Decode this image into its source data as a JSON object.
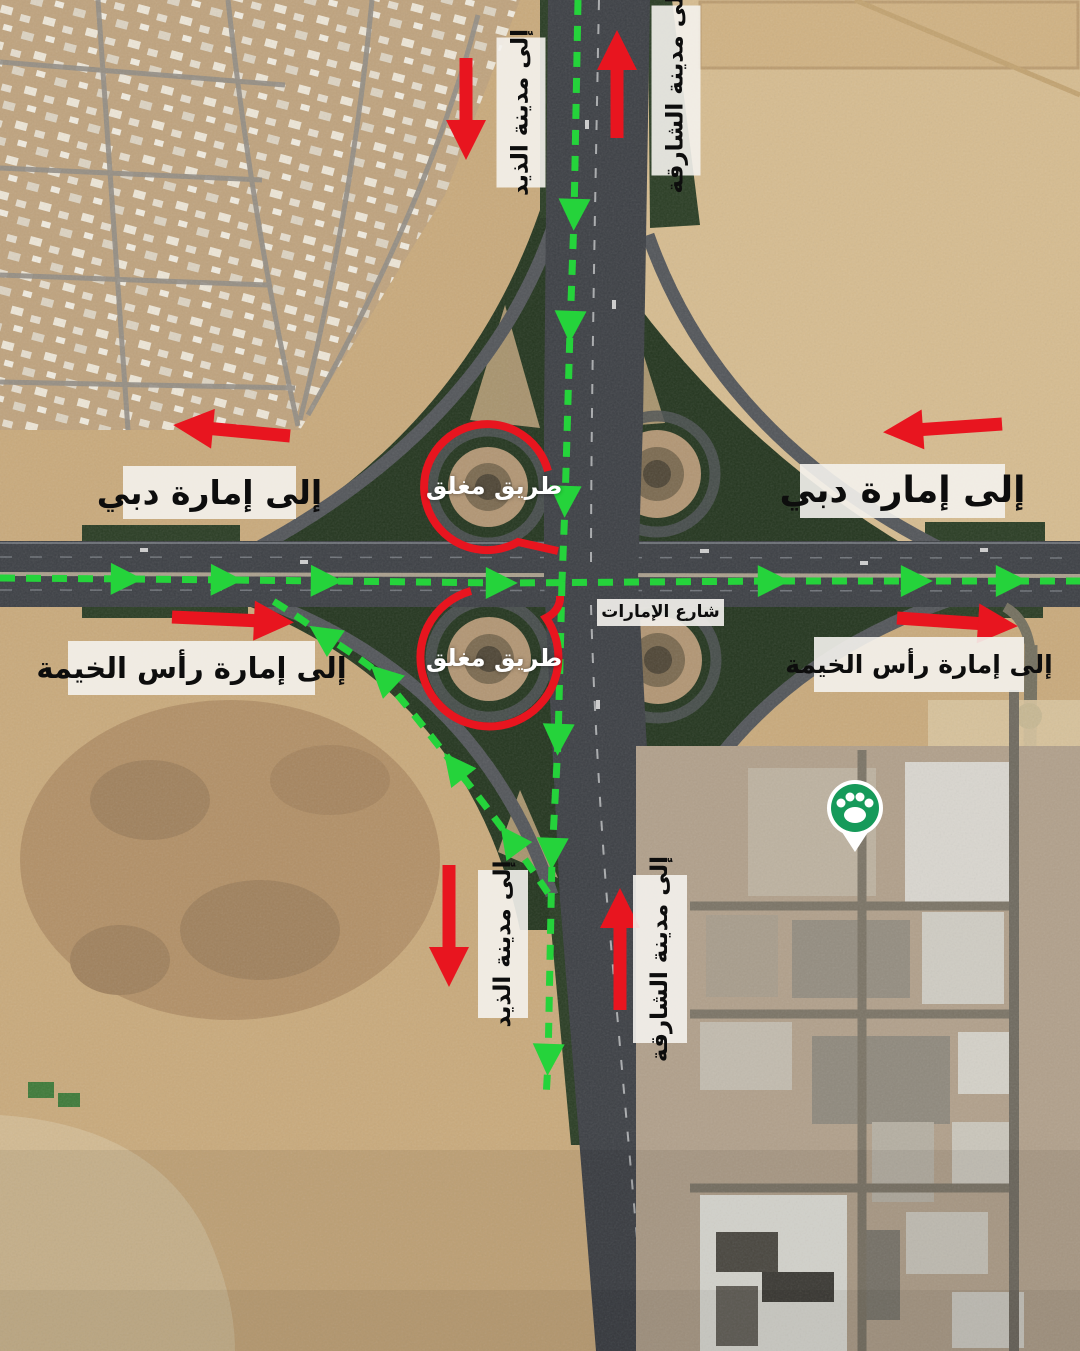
{
  "map": {
    "street_sign": {
      "text": "شارع الإمارات"
    },
    "closed_markers": [
      {
        "label": "طريق مغلق"
      },
      {
        "label": "طريق مغلق"
      }
    ],
    "direction_labels": {
      "to_dhaid_top": "إلى مدينة الذيد",
      "to_sharjah_top": "إلى مدينة الشارقة",
      "to_dubai_left": "إلى إمارة دبي",
      "to_dubai_right": "إلى إمارة دبي",
      "to_rak_left": "إلى إمارة رأس الخيمة",
      "to_rak_right": "إلى إمارة رأس الخيمة",
      "to_dhaid_bottom": "إلى مدينة الذيد",
      "to_sharjah_bottom": "إلى مدينة الشارقة"
    },
    "legend_colors": {
      "closed_road_red": "#e8151f",
      "detour_route_green": "#25d33b",
      "label_background": "#f4f2ed",
      "closed_text_white": "#ffffff",
      "pin_green": "#169a5a"
    },
    "icons": {
      "pet_place_pin": "paw-pin-icon"
    }
  }
}
